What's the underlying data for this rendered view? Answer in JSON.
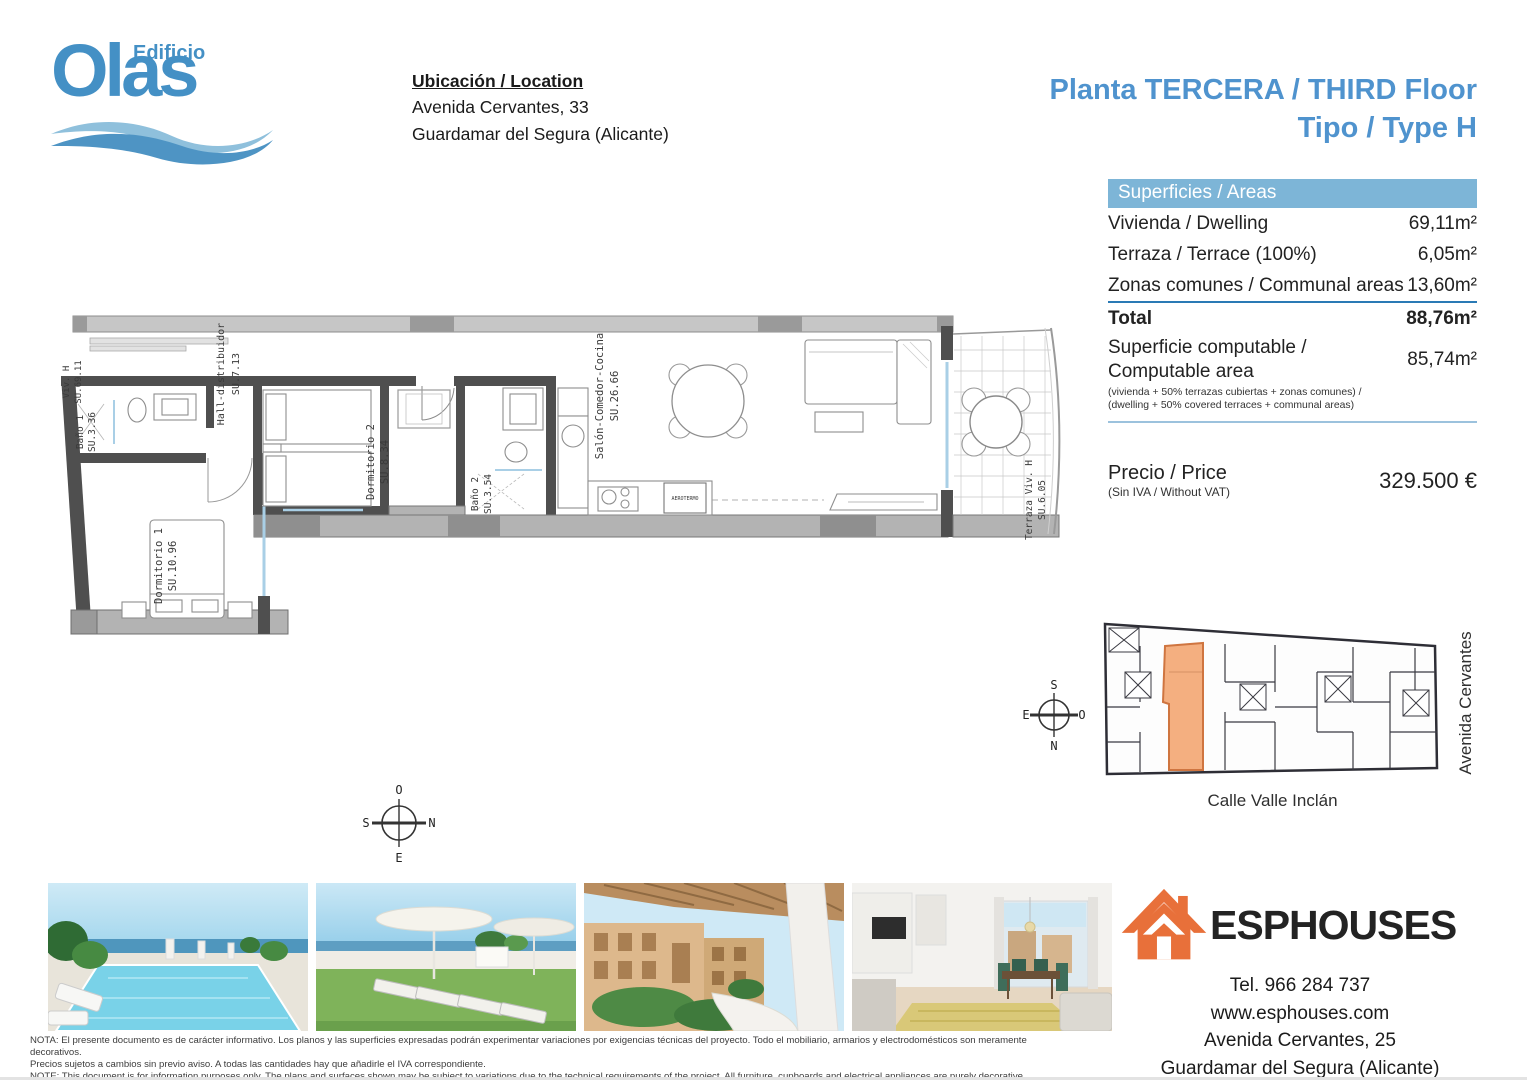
{
  "logo": {
    "brand": "Olas",
    "edificio": "Edificio"
  },
  "location": {
    "heading": "Ubicación / Location",
    "address_line1": "Avenida Cervantes, 33",
    "address_line2": "Guardamar del Segura (Alicante)"
  },
  "plan_title": {
    "line1": "Planta TERCERA / THIRD Floor",
    "line2": "Tipo / Type H"
  },
  "areas_table": {
    "header": "Superficies / Areas",
    "rows": [
      {
        "label": "Vivienda / Dwelling",
        "value": "69,11m²"
      },
      {
        "label": "Terraza / Terrace (100%)",
        "value": "6,05m²"
      },
      {
        "label": "Zonas comunes / Communal areas",
        "value": "13,60m²"
      }
    ],
    "total_label": "Total",
    "total_value": "88,76m²",
    "computable_label_line1": "Superficie computable /",
    "computable_label_line2": "Computable area",
    "computable_note1": "(vivienda + 50% terrazas cubiertas + zonas comunes) /",
    "computable_note2": "(dwelling + 50% covered terraces + communal areas)",
    "computable_value": "85,74m²"
  },
  "price": {
    "label": "Precio / Price",
    "note": "(Sin IVA / Without VAT)",
    "value": "329.500 €"
  },
  "floorplan": {
    "unit_label": "Viv. H",
    "unit_area": "SU.69.11",
    "rooms": [
      {
        "name": "Baño 1",
        "area": "SU.3.36"
      },
      {
        "name": "Hall-distribuidor",
        "area": "SU.7.13"
      },
      {
        "name": "Dormitorio 1",
        "area": "SU.10.96"
      },
      {
        "name": "Dormitorio 2",
        "area": "SU.8.34"
      },
      {
        "name": "Baño 2",
        "area": "SU.3.54"
      },
      {
        "name": "Salón-Comedor-Cocina",
        "area": "SU.26.66"
      },
      {
        "name": "Terraza Viv. H",
        "area": "SU.6.05"
      }
    ],
    "equipment_label": "AEROTERMO",
    "compass": {
      "top": "O",
      "left": "S",
      "right": "N",
      "bottom": "E"
    }
  },
  "siteplan": {
    "street_bottom": "Calle Valle Inclán",
    "street_right": "Avenida Cervantes",
    "compass": {
      "top": "S",
      "left": "E",
      "right": "O",
      "bottom": "N"
    }
  },
  "agency": {
    "name": "ESPHOUSES",
    "phone": "Tel. 966 284 737",
    "web": "www.esphouses.com",
    "address1": "Avenida Cervantes, 25",
    "address2": "Guardamar del Segura (Alicante)"
  },
  "notes": {
    "line1": "NOTA: El presente documento es de carácter informativo. Los planos y las superficies expresadas podrán experimentar variaciones por exigencias técnicas del proyecto. Todo el mobiliario, armarios y electrodomésticos son meramente decorativos.",
    "line2": "Precios sujetos a cambios sin previo aviso. A todas las cantidades hay que añadirle el IVA correspondiente.",
    "line3": "NOTE: This document is for information purposes only. The plans and surfaces shown may be subject to variations due to the technical requirements of the project. All furniture, cupboards and electrical appliances are purely decorative.",
    "line4": "Prices subject to change without notice. VAT must be added to all amounts."
  }
}
